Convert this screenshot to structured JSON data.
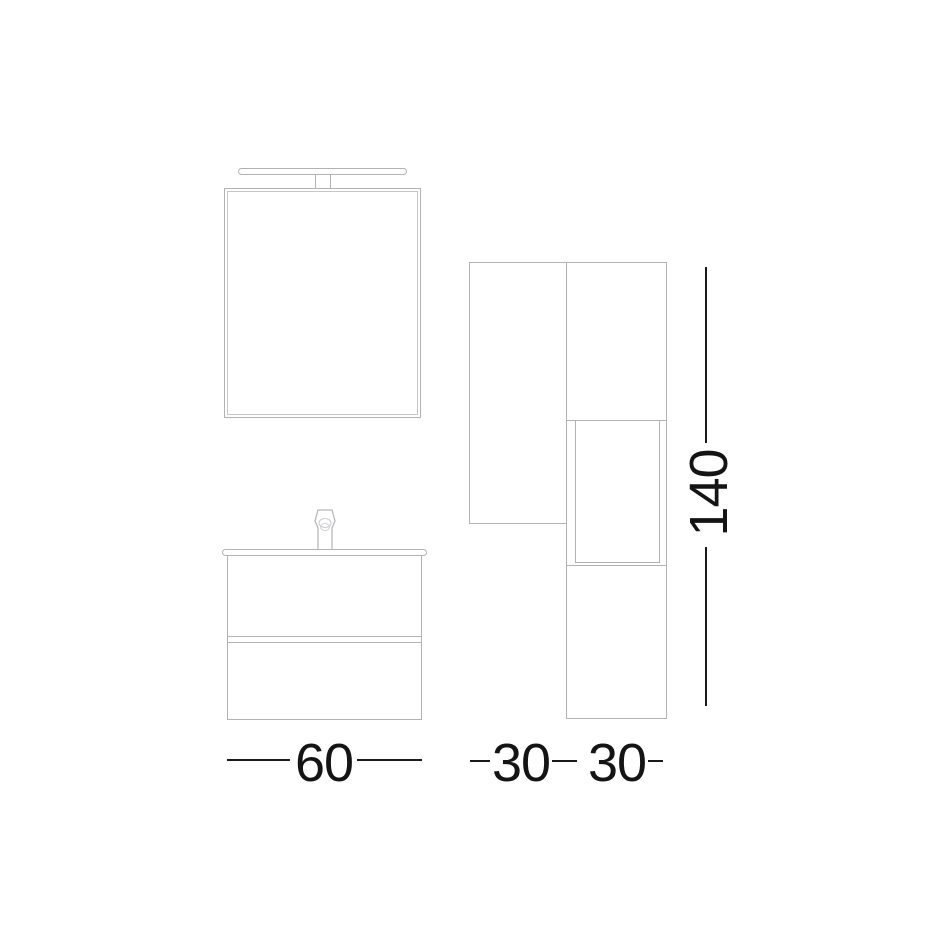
{
  "diagram": {
    "type": "bathroom-furniture-technical-drawing",
    "colors": {
      "background": "#ffffff",
      "furniture_line": "#b2b2b5",
      "dimension_line": "#1a1a1a",
      "dimension_text": "#141414"
    },
    "views": {
      "front": [
        "light-fixture",
        "mirror-cabinet",
        "faucet",
        "countertop",
        "vanity-cabinet-two-drawers"
      ],
      "side": [
        "wall-cabinet",
        "tall-column-cabinet-with-door-panel"
      ]
    },
    "dimensions": {
      "vanity_width": "60",
      "left_unit_width": "30",
      "right_unit_width": "30",
      "column_height": "140"
    }
  }
}
